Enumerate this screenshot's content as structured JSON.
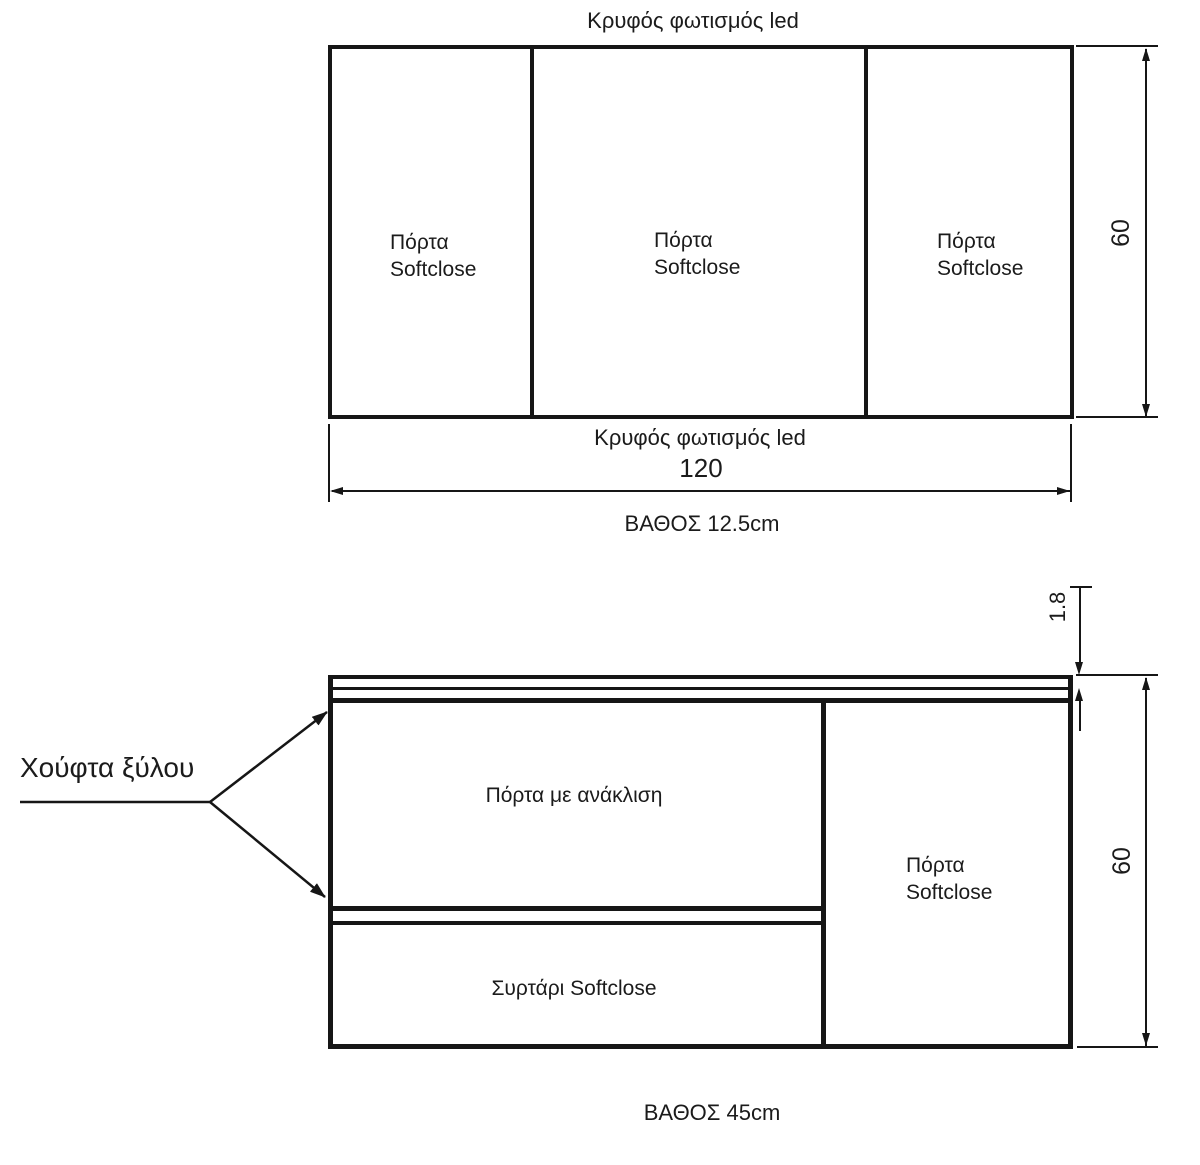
{
  "colors": {
    "line": "#161616",
    "background": "#ffffff"
  },
  "top_view": {
    "label_top": "Κρυφός φωτισμός led",
    "label_bottom": "Κρυφός φωτισμός led",
    "doors": [
      {
        "line1": "Πόρτα",
        "line2": "Softclose"
      },
      {
        "line1": "Πόρτα",
        "line2": "Softclose"
      },
      {
        "line1": "Πόρτα",
        "line2": "Softclose"
      }
    ],
    "dim_width": "120",
    "dim_height": "60",
    "depth_label": "ΒΑΘΟΣ 12.5cm"
  },
  "bottom_view": {
    "leader_label": "Χούφτα ξύλου",
    "tilt_door_label": "Πόρτα με ανάκλιση",
    "drawer_label": "Συρτάρι Softclose",
    "right_door": {
      "line1": "Πόρτα",
      "line2": "Softclose"
    },
    "dim_top_thickness": "1.8",
    "dim_height": "60",
    "depth_label": "ΒΑΘΟΣ 45cm"
  }
}
